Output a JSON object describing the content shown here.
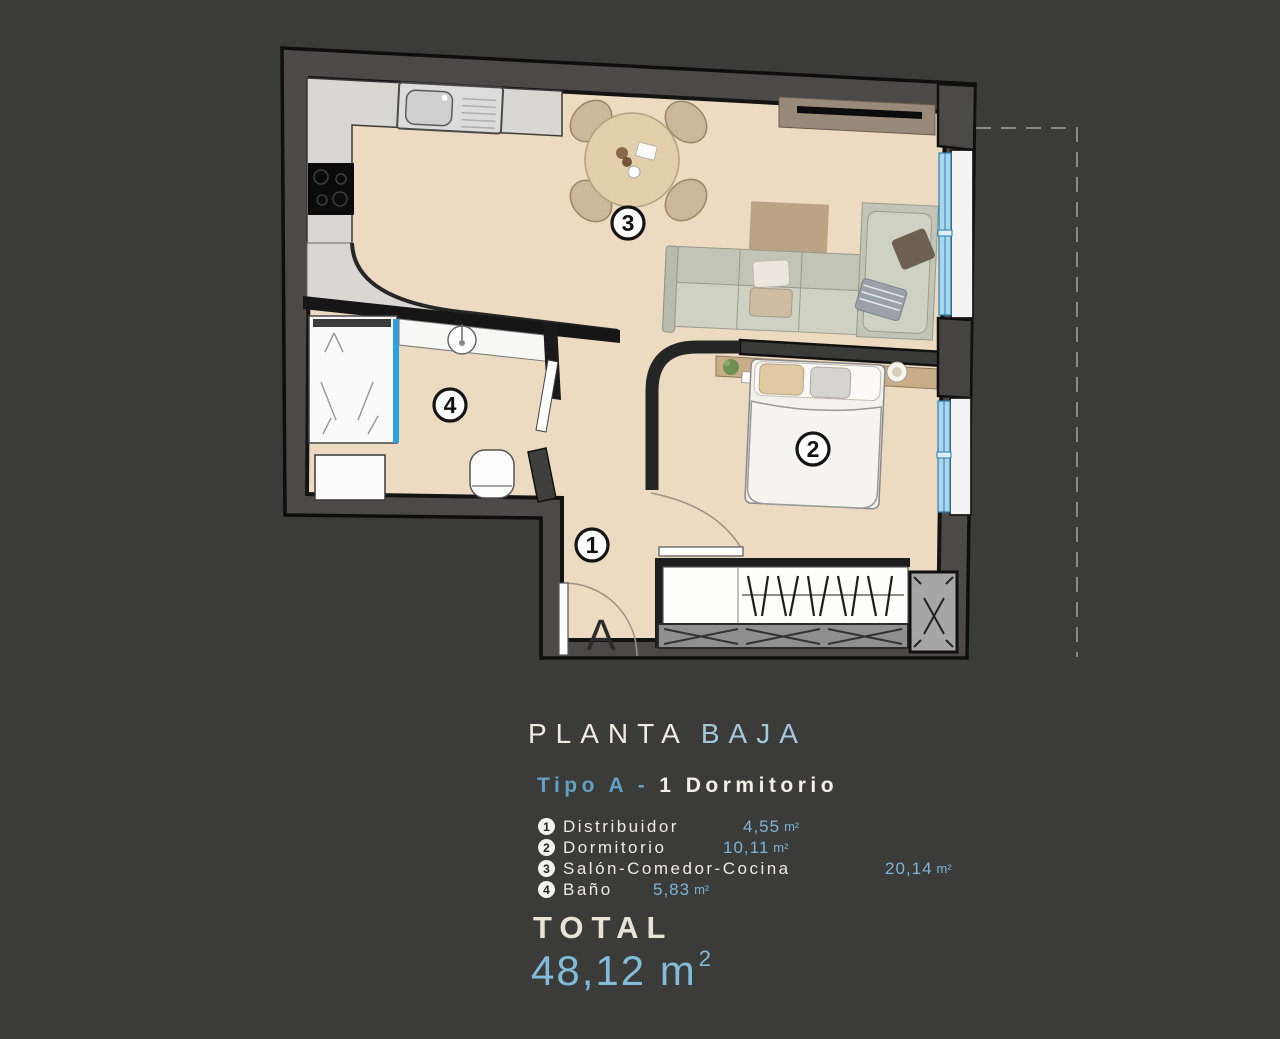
{
  "title": {
    "main": "PLANTA",
    "accent": "BAJA"
  },
  "subtitle": {
    "accent": "Tipo A -",
    "rest": "1 Dormitorio"
  },
  "legend": [
    {
      "num": "1",
      "name": "Distribuidor",
      "area": "4,55",
      "unit": "m²"
    },
    {
      "num": "2",
      "name": "Dormitorio",
      "area": "10,11",
      "unit": "m²"
    },
    {
      "num": "3",
      "name": "Salón-Comedor-Cocina",
      "area": "20,14",
      "unit": "m²"
    },
    {
      "num": "4",
      "name": "Baño",
      "area": "5,83",
      "unit": "m²"
    }
  ],
  "total": {
    "label": "TOTAL",
    "value": "48,12 m",
    "sup": "2"
  },
  "plan": {
    "unit_letter": "A",
    "labels": {
      "distribuidor": "1",
      "dormitorio": "2",
      "salon": "3",
      "bano": "4"
    }
  },
  "colors": {
    "background": "#3b3b3a",
    "wall": "#4b4a49",
    "floor": "#ecdbc0",
    "accent_blue": "#7db4d6",
    "glass_blue": "#a9d6ec",
    "text_white": "#efece6"
  }
}
